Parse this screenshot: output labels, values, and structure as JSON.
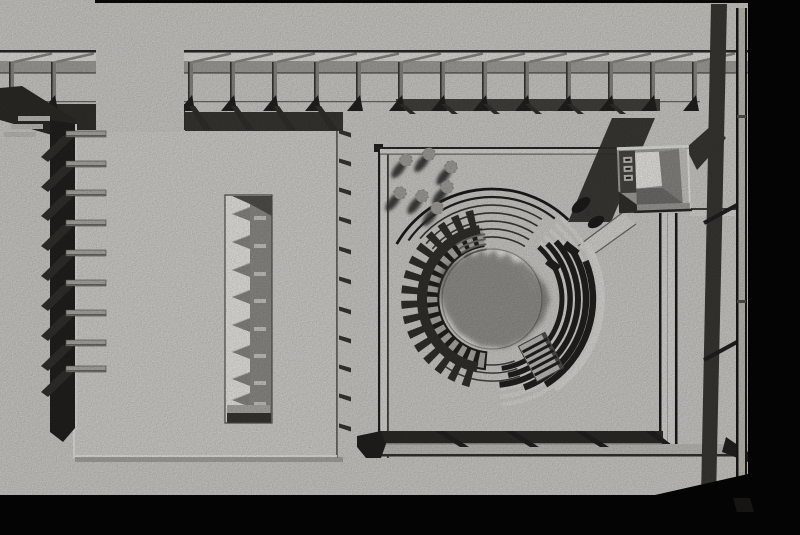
{
  "meta": {
    "title": "Black-and-white aerial photograph of an architectural scale model",
    "description": "Top-down view of a physical model: a colonnade band along the top, a column of cantilevered fins on the left, a large slab with a toothed slot cutout, and a square plaza containing a circular stepped amphitheater, seven small trees, a roofless kiosk with an open lit interior, a connecting path with a figure, and a long rail along the right edge. Strong shadows fall toward the lower left. Black photo background borders the right and bottom."
  },
  "palette": {
    "black": "#060606",
    "base": "#d7d6d2",
    "base_light": "#e2e1dd",
    "white": "#f4f3ef",
    "mid_gray": "#a8a7a2",
    "gray": "#8f8e89",
    "dark_gray": "#55544f",
    "shadow": "#3a3935",
    "deep": "#23221f",
    "line": "#6e6d69",
    "band": "#33322e",
    "inner_floor": "#edece8",
    "blocks": "#b4b3ad",
    "beam_light": "#c6c5c1",
    "slab": "#dcdbd7",
    "slot_gray": "#94938e"
  },
  "scene": {
    "objects": [
      "top-colonnade",
      "left-fin-column",
      "slotted-slab",
      "plaza-frame",
      "amphitheater",
      "tree-cluster",
      "kiosk-building",
      "path-with-figure",
      "right-rail",
      "photo-black-border"
    ],
    "counts": {
      "colonnade_posts": 15,
      "left_fins": 9,
      "slot_teeth": 8,
      "slab_edge_brackets": 11,
      "trees": 7,
      "bottom_frame_struts": 4
    }
  }
}
